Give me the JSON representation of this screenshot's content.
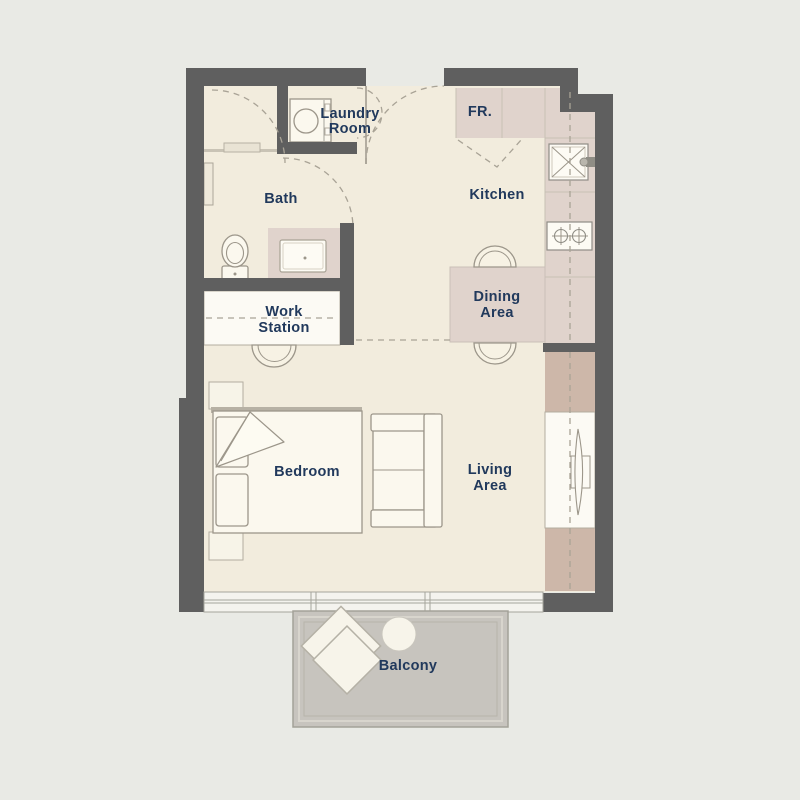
{
  "title": "Studio Apartment Floor Plan",
  "colors": {
    "background": "#e9eae5",
    "floor": "#f2ecdd",
    "wall": "#5f5f5f",
    "counter": "#e0d3cc",
    "wardrobe": "#cdb7a9",
    "balcony_floor": "#c7c4be",
    "furniture_fill": "#fbf8ee",
    "furniture_stroke": "#9c968a",
    "dashed_line": "#a9a396",
    "light_line": "#c7c0b4",
    "label_text": "#21395c"
  },
  "labels": {
    "laundry_line1": "Laundry",
    "laundry_line2": "Room",
    "bath": "Bath",
    "kitchen": "Kitchen",
    "fridge": "FR.",
    "dining_line1": "Dining",
    "dining_line2": "Area",
    "workstation_line1": "Work",
    "workstation_line2": "Station",
    "bedroom": "Bedroom",
    "living_line1": "Living",
    "living_line2": "Area",
    "balcony": "Balcony"
  }
}
